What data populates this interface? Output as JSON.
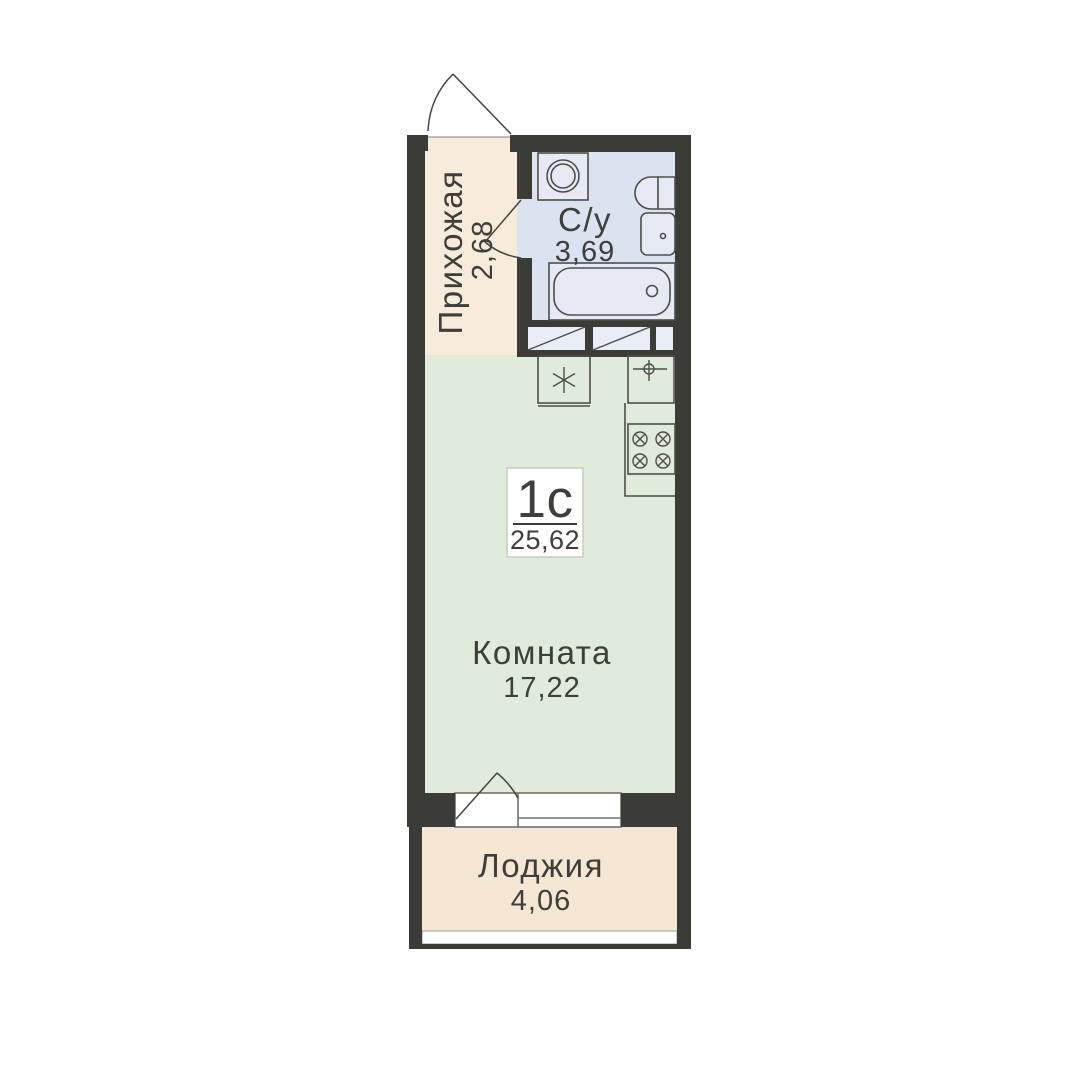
{
  "unit": {
    "type_label": "1с",
    "total_area": "25,62"
  },
  "rooms": {
    "hallway": {
      "name": "Прихожая",
      "area": "2,68"
    },
    "bathroom": {
      "name": "С/у",
      "area": "3,69"
    },
    "living": {
      "name": "Комната",
      "area": "17,22"
    },
    "loggia": {
      "name": "Лоджия",
      "area": "4,06"
    }
  },
  "colors": {
    "wall": "#3b3b38",
    "hallway_fill": "#f7ebdb",
    "bathroom_fill": "#dce3f0",
    "living_fill": "#e0ebdc",
    "loggia_fill": "#f5e7d4",
    "fixture_fill": "#e6eaf5",
    "closet_fill": "#e9edf7",
    "outline": "#4e4e49",
    "door_line": "#45453f",
    "glazing_fill": "#ffffff",
    "frame_line": "#70706b",
    "thin_line": "#9b9b96",
    "text": "#3e3e3b",
    "plaque_border": "#c9c9c4",
    "plaque_fill": "#ffffff"
  }
}
